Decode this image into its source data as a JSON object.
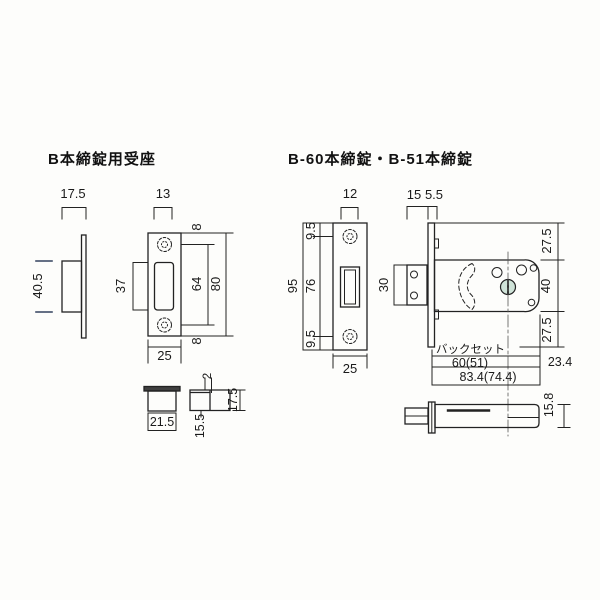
{
  "diagram": {
    "left": {
      "title": "B本締錠用受座",
      "dims": {
        "box_depth_total": "17.5",
        "slot_width": "13",
        "box_height": "40.5",
        "slot_height": "37",
        "top_margin": "8",
        "hole_span": "64",
        "plate_height": "80",
        "bottom_margin": "8",
        "plate_width": "25",
        "dust_box_width": "21.5",
        "lip_thickness": "2",
        "dust_box_depth": "15.5",
        "dust_box_total_depth": "17.5"
      }
    },
    "right": {
      "title": "B-60本締錠・B-51本締錠",
      "dims": {
        "slot_width": "12",
        "case_offset": "15",
        "faceplate_thickness": "5.5",
        "plate_height": "95",
        "top_margin": "9.5",
        "hole_span": "76",
        "bottom_margin": "9.5",
        "plate_width": "25",
        "strike_box_height": "30",
        "body_top_margin": "27.5",
        "body_height": "40",
        "body_bottom_margin": "27.5",
        "backset_label": "バックセット",
        "backset_value": "60(51)",
        "case_extra": "23.4",
        "case_total": "83.4(74.4)",
        "body_thickness": "15.8"
      }
    },
    "colors": {
      "line": "#222222",
      "screw_tint": "#cfe3d8"
    }
  }
}
